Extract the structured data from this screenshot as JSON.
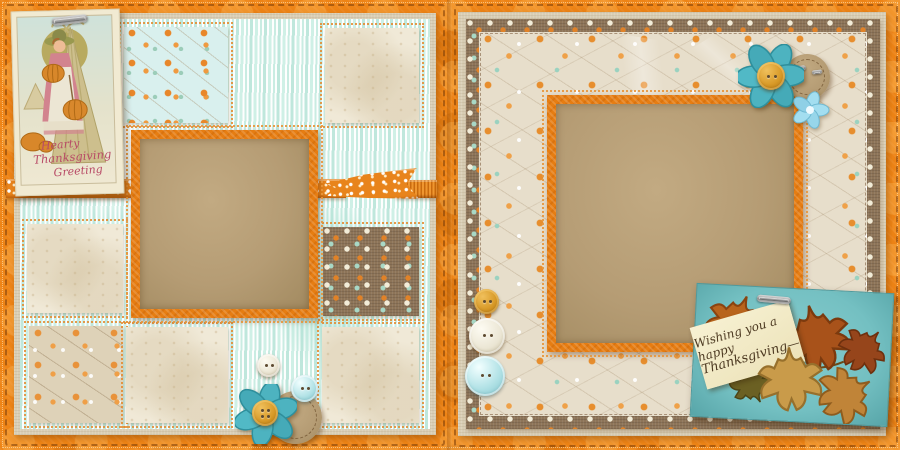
{
  "scene": {
    "type": "digital-scrapbook-layout",
    "theme": "Thanksgiving",
    "pages": 2
  },
  "palette": {
    "orange_base": "#ee8416",
    "kraft_brown": "#b59c74",
    "wood_aqua": "#d9f0ea",
    "linen": "#d9ceb5",
    "polka_brown": "#8d7458",
    "teal_flower": "#4db3c0",
    "card_teal": "#74c0c2",
    "cream": "#f0e9d7"
  },
  "left_page": {
    "postcard": {
      "line1": "Hearty",
      "line2": "Thanksgiving",
      "line3": "Greeting"
    },
    "embellishments": [
      "paperclip-icon",
      "orange-polka-ribbon",
      "white-button",
      "aqua-button",
      "teal-flower",
      "kraft-circle-tag"
    ]
  },
  "right_page": {
    "leaf_card": {
      "line1": "Wishing you a happy",
      "line2": "Thanksgiving—"
    },
    "embellishments": [
      "teal-flower",
      "blue-flower",
      "kraft-circle-tag",
      "mustard-button",
      "white-button",
      "aqua-button",
      "metal-clip-icon"
    ]
  }
}
